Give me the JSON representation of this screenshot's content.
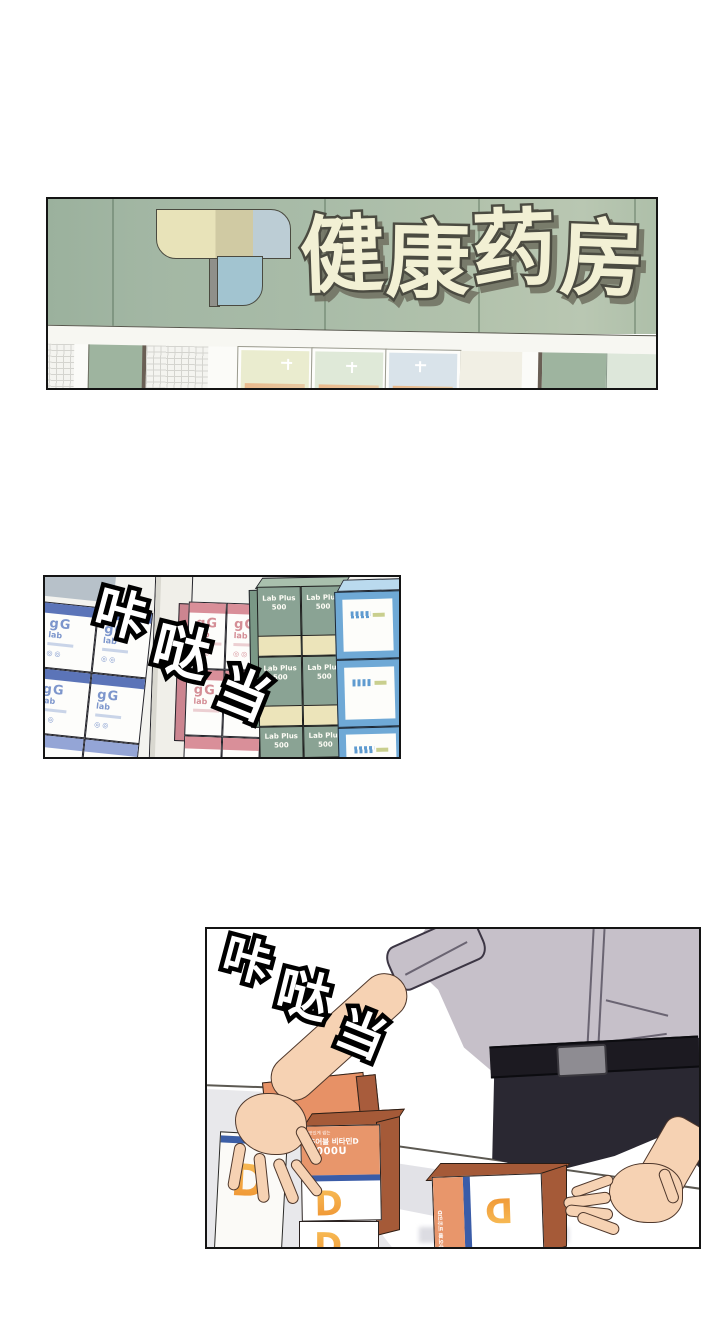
{
  "comic": {
    "panel1": {
      "sign_text": "健康药房",
      "colors": {
        "sign_green": "#a9bca8",
        "logo_beige": "#e8e3b9",
        "logo_tan": "#d0caa3",
        "logo_lightblue": "#bccdd5",
        "logo_blue": "#a2c4d0",
        "title_cream": "#f2f0d4"
      }
    },
    "panel2": {
      "sfx": "咔哒当",
      "labels": {
        "gg": "gG",
        "lab": "lab",
        "marks": "◎◎",
        "green1": "Lab Plus",
        "green2": "500"
      },
      "colors": {
        "blue_band": "#5b74b8",
        "pink_band": "#d98f99",
        "green_box": "#8aa394",
        "cream_band": "#ece4ba",
        "blue_box": "#6fa9d6"
      }
    },
    "panel3": {
      "sfx": "咔哒当",
      "vitamin_box": {
        "tagline": "맛있게 씹는",
        "product": "츄어블 비타민D",
        "dose": "3000U",
        "logo_letter": "D"
      },
      "colors": {
        "box_orange": "#e8966b",
        "box_side": "#a55a38",
        "stripe_blue": "#3a5ca8",
        "shirt": "#c6c0c9",
        "pants": "#2a2832",
        "skin": "#f6d2b3"
      }
    }
  }
}
